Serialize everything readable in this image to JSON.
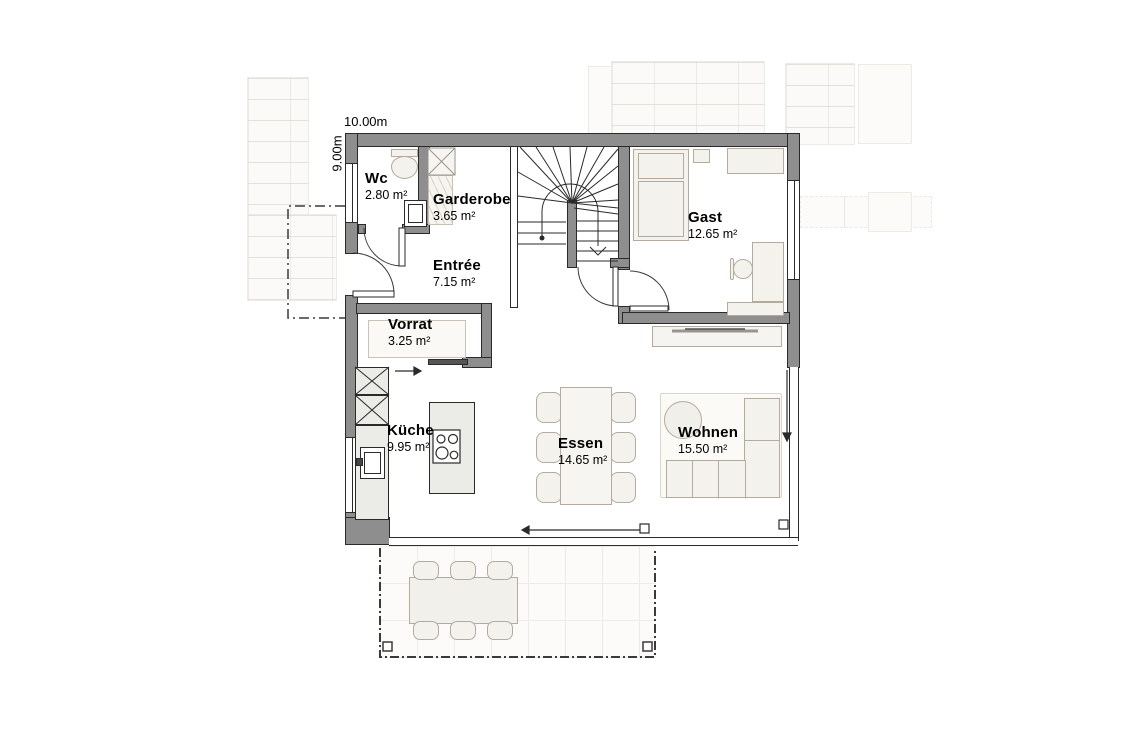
{
  "plan": {
    "type": "floor-plan",
    "level": "ground-floor"
  },
  "dimensions": {
    "width_label": "10.00m",
    "height_label": "9.00m"
  },
  "rooms": [
    {
      "id": "wc",
      "name": "Wc",
      "area": "2.80 m²"
    },
    {
      "id": "garderobe",
      "name": "Garderobe",
      "area": "3.65 m²"
    },
    {
      "id": "entree",
      "name": "Entrée",
      "area": "7.15 m²"
    },
    {
      "id": "gast",
      "name": "Gast",
      "area": "12.65 m²"
    },
    {
      "id": "vorrat",
      "name": "Vorrat",
      "area": "3.25 m²"
    },
    {
      "id": "kueche",
      "name": "Küche",
      "area": "9.95 m²"
    },
    {
      "id": "essen",
      "name": "Essen",
      "area": "14.65 m²"
    },
    {
      "id": "wohnen",
      "name": "Wohnen",
      "area": "15.50 m²"
    }
  ],
  "colors": {
    "wall": "#8e8e8e",
    "outline": "#2a2a2a",
    "furniture_fill": "#f4f2ed",
    "furniture_border": "#b4ab9e",
    "counter_fill": "#ebebe8",
    "background": "#ffffff",
    "faint_paving": "#edebe6"
  }
}
